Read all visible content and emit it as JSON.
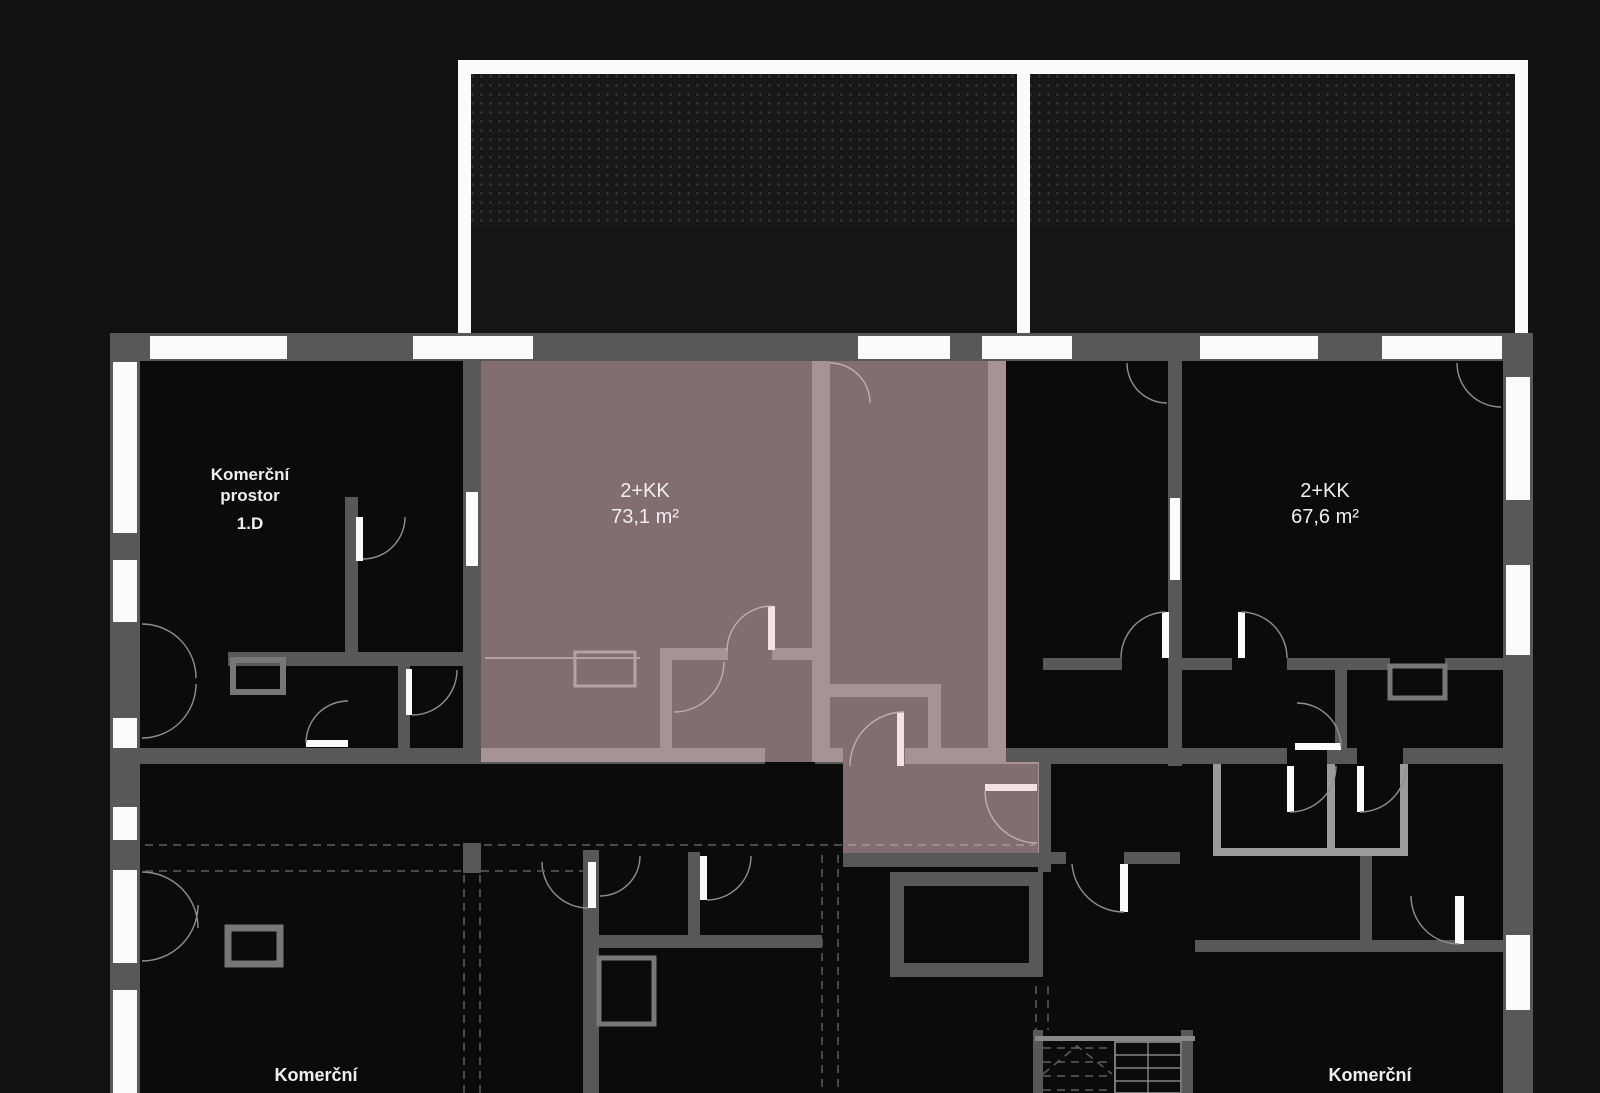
{
  "page_title": "Podlaží – půdorys (floor plan)",
  "colors": {
    "bg": "#121212",
    "floor": "#0b0b0b",
    "wall": "#585858",
    "wallLight": "#9b9b9b",
    "win": "#fbfbfb",
    "terrace": "#181818",
    "terraceLow": "#151515",
    "dot": "#3c3c3c",
    "overlay": "#f0c9ce",
    "text": "#efefef",
    "arc": "#909090",
    "dash": "#5e5e5e",
    "fixture": "#777777"
  },
  "units": {
    "commercial_top": {
      "line1": "Komerční",
      "line2": "prostor",
      "number": "1.D"
    },
    "apartment_highlighted": {
      "type": "2+KK",
      "area": "73,1 m²"
    },
    "apartment_right": {
      "type": "2+KK",
      "area": "67,6 m²"
    },
    "commercial_bottom_left": {
      "label": "Komerční"
    },
    "commercial_bottom_right": {
      "label": "Komerční"
    }
  }
}
